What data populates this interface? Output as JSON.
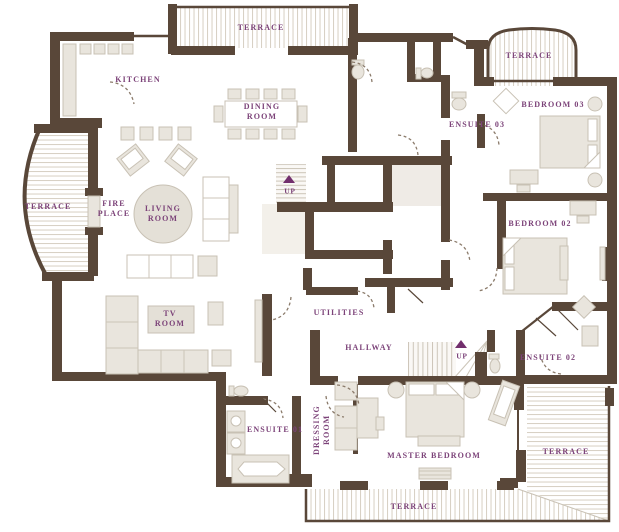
{
  "title": "Apartment floor plan",
  "colors": {
    "wall": "#594739",
    "label": "#7c4379",
    "furniture": "#e9e5dd",
    "furniture_line": "#c8c1b4",
    "stripe": "#d8d1c5",
    "rug": "#e4e0d7",
    "shaft": "#efebe6",
    "arrow": "#722f6d",
    "tread": "#ccc5b8",
    "door_arc": "#8b7b6b",
    "background": "#ffffff"
  },
  "labels": {
    "terrace_top": "TERRACE",
    "terrace_top_right": "TERRACE",
    "terrace_left": "TERRACE",
    "terrace_right": "TERRACE",
    "terrace_bottom": "TERRACE",
    "kitchen": "KITCHEN",
    "dining_room": "DINING\nROOM",
    "living_room": "LIVING\nROOM",
    "fire_place": "FIRE\nPLACE",
    "tv_room": "TV\nROOM",
    "bedroom_03": "BEDROOM 03",
    "ensuite_03": "ENSUITE 03",
    "bedroom_02": "BEDROOM 02",
    "ensuite_02": "ENSUITE 02",
    "ensuite_01": "ENSUITE 01",
    "utilities": "UTILITIES",
    "hallway": "HALLWAY",
    "dressing_room": "DRESSING\nROOM",
    "master_bedroom": "MASTER BEDROOM",
    "up_stair_1": "UP",
    "up_stair_2": "UP"
  }
}
